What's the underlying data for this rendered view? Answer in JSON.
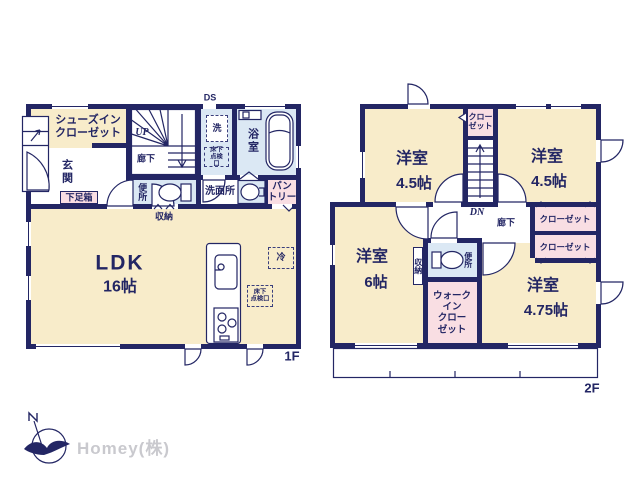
{
  "floor1": {
    "floor_label": "1F",
    "shoes_in_closet": "シューズイン\nクローゼット",
    "entrance": "玄関",
    "shoe_box": "下足箱",
    "hallway": "廊下",
    "stairs_up": "UP",
    "duct_space": "DS",
    "washer": "洗",
    "underfloor_hatch": "床下\n点検口",
    "bathroom": "浴室",
    "toilet": "便所",
    "washroom": "洗面所",
    "pantry": "パン\nトリー",
    "storage": "収納",
    "ldk_name": "LDK",
    "ldk_size": "16帖",
    "fridge": "冷",
    "underfloor_hatch2": "床下\n点検口"
  },
  "floor2": {
    "floor_label": "2F",
    "room_nw": "洋室",
    "room_nw_size": "4.5帖",
    "room_ne": "洋室",
    "room_ne_size": "4.5帖",
    "room_w": "洋室",
    "room_w_size": "6帖",
    "room_se": "洋室",
    "room_se_size": "4.75帖",
    "closet_top": "クロー\nゼット",
    "closet_e1": "クローゼット",
    "closet_e2": "クローゼット",
    "walk_in_closet": "ウォーク\nイン\nクロー\nゼット",
    "hallway": "廊下",
    "stairs_down": "DN",
    "toilet": "便所",
    "storage": "収納"
  },
  "logo": {
    "company": "Homey(株)"
  },
  "colors": {
    "wall": "#232664",
    "room_cream": "#f8ecca",
    "wet_blue": "#dbe8f4",
    "closet_pink": "#f9dee3",
    "logo_gray": "#c9c9ce"
  }
}
